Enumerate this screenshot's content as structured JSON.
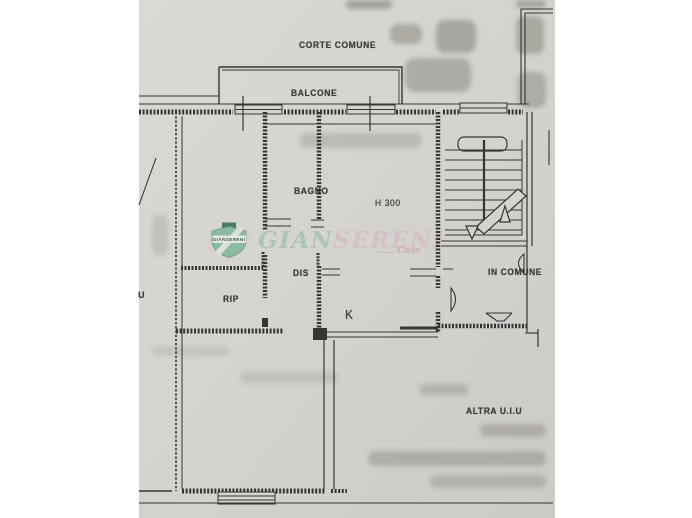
{
  "document": {
    "kind": "scanned floor plan page",
    "paper_color": "#d5d3ce",
    "ink_color": "#1f1f1f"
  },
  "plan_labels": {
    "courtyard": "CORTE COMUNE",
    "balcony": "BALCONE",
    "bathroom": "BAGNO",
    "ceiling_height": "H 300",
    "hallway": "DIS",
    "storage": "RIP",
    "kitchen": "K",
    "shared_area": "IN COMUNE",
    "other_unit": "ALTRA U.I.U",
    "left_edge_cut_label": "U"
  },
  "watermark": {
    "logo_band_text": "GIANSERENI",
    "name_part1": "GIAN",
    "name_part2": "SERENI",
    "tagline": "Case",
    "green": "#9fbfae",
    "pink": "#d8bac5"
  }
}
